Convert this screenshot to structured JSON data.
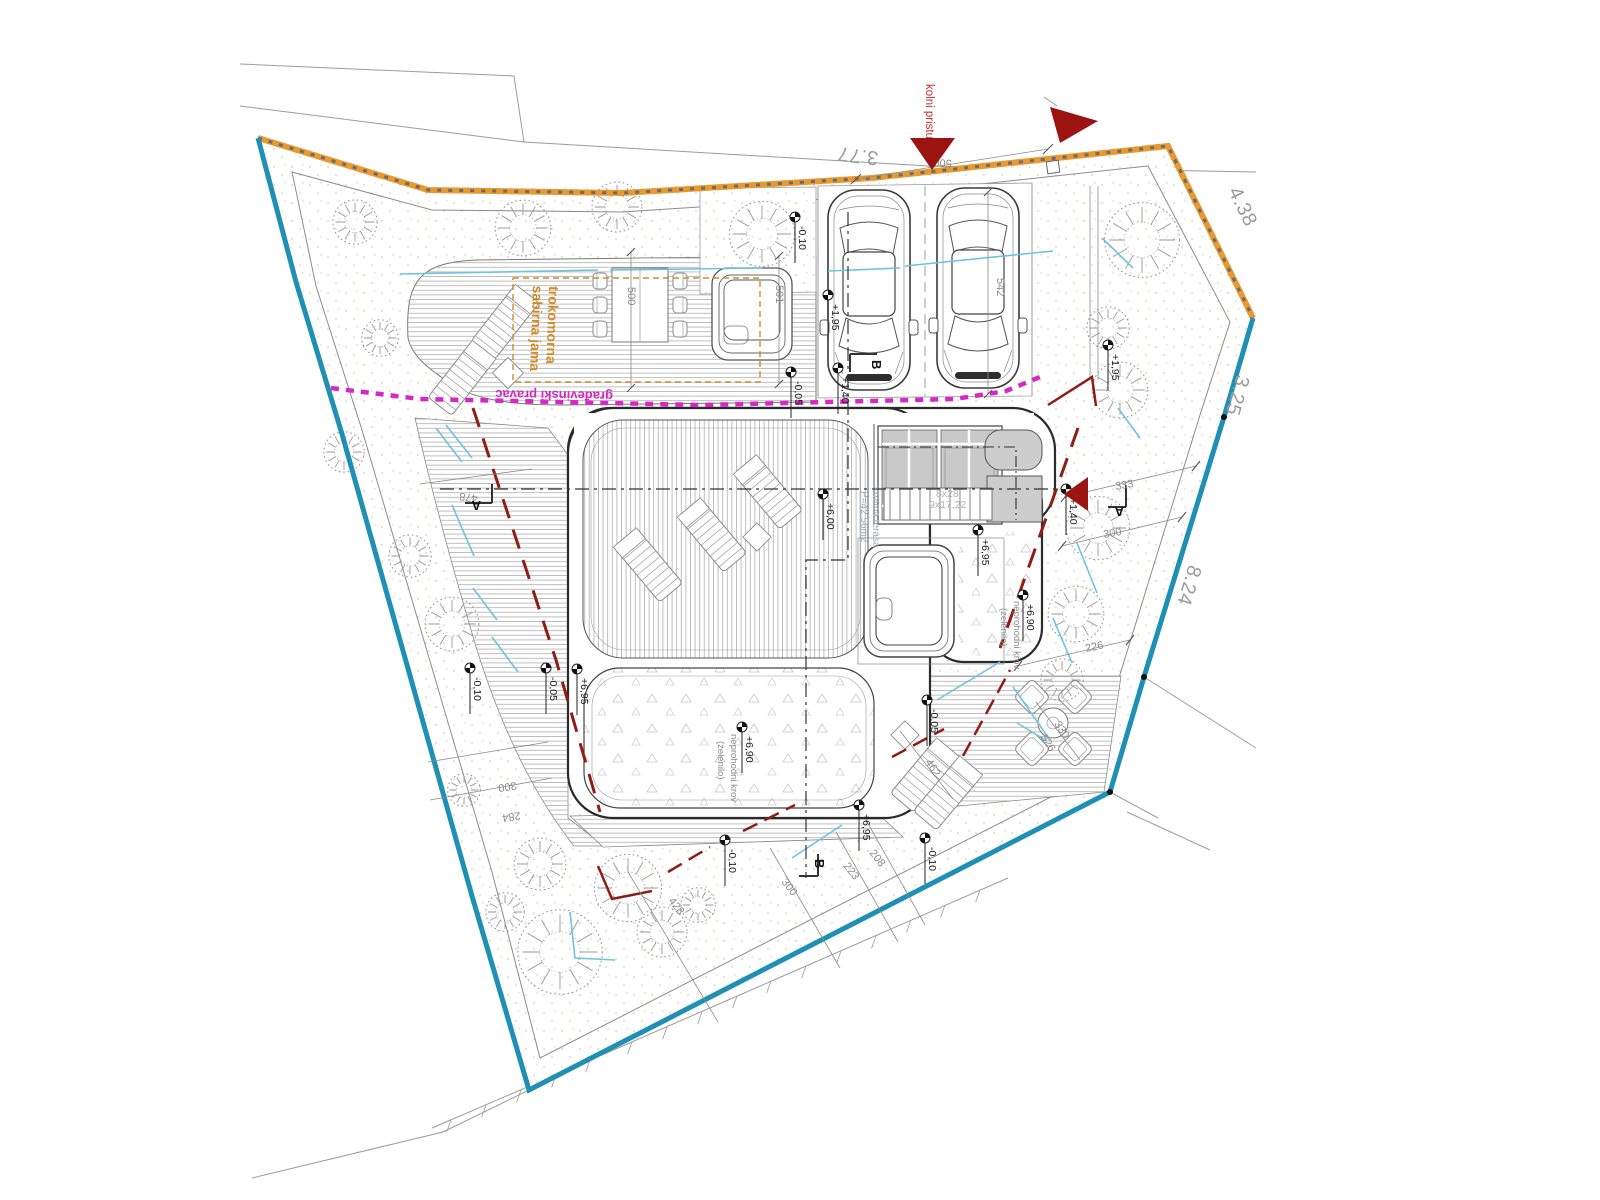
{
  "labels": {
    "access": "kolni pristup",
    "regulation": "građevinski pravac",
    "septic1": "trokomorna",
    "septic2": "sabirna jama",
    "terrace1": "krovna terasa",
    "terrace2": "P=42,56m2",
    "greenroof1": "neprohodni krov",
    "greenroof2": "(zelenilo)",
    "stairs1": "8x28",
    "stairs2": "9x17,22",
    "section_a": "A",
    "section_b": "B"
  },
  "boundary_lengths": [
    {
      "t": "3.77"
    },
    {
      "t": "4.38"
    },
    {
      "t": "3.25"
    },
    {
      "t": "8.24"
    }
  ],
  "dimensions": [
    {
      "t": "500"
    },
    {
      "t": "500"
    },
    {
      "t": "501"
    },
    {
      "t": "542"
    },
    {
      "t": "478"
    },
    {
      "t": "333"
    },
    {
      "t": "300"
    },
    {
      "t": "226"
    },
    {
      "t": "330"
    },
    {
      "t": "326"
    },
    {
      "t": "462"
    },
    {
      "t": "208"
    },
    {
      "t": "223"
    },
    {
      "t": "300"
    },
    {
      "t": "428"
    },
    {
      "t": "300"
    },
    {
      "t": "284"
    }
  ],
  "levels": [
    {
      "t": "-0,10"
    },
    {
      "t": "+1,95"
    },
    {
      "t": "+1,40"
    },
    {
      "t": "-0,05"
    },
    {
      "t": "+1,95"
    },
    {
      "t": "+1,40"
    },
    {
      "t": "+6,00"
    },
    {
      "t": "+6,90"
    },
    {
      "t": "+6,90"
    },
    {
      "t": "+6,95"
    },
    {
      "t": "+6,95"
    },
    {
      "t": "+6,95"
    },
    {
      "t": "-0,10"
    },
    {
      "t": "-0,05"
    },
    {
      "t": "-0,10"
    },
    {
      "t": "-0,10"
    },
    {
      "t": "-0,05"
    }
  ],
  "colors": {
    "plot_boundary_blue": "#1f8fb4",
    "street_boundary_orange": "#e89a30",
    "regulation_line_magenta": "#d529c6",
    "access_arrow_red": "#9c1412",
    "roof_edge_red": "#8e1d15",
    "utility_cyan": "#6ec3de",
    "note_orange": "#d08a28"
  }
}
